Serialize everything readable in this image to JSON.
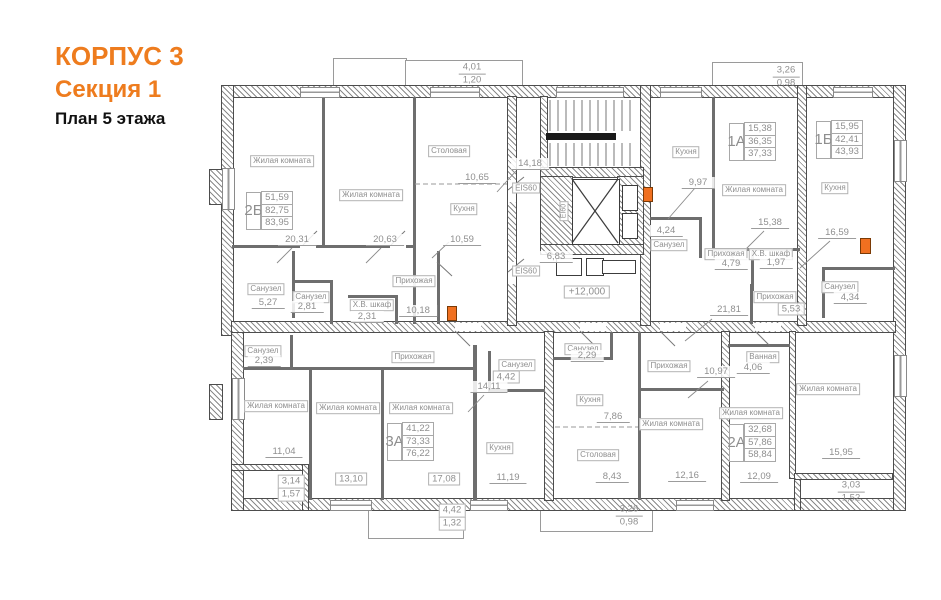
{
  "title": {
    "building": "КОРПУС 3",
    "section": "Секция 1",
    "plan": "План 5 этажа"
  },
  "colors": {
    "accent": "#ee7c1e",
    "wall": "#4d4d4d",
    "label_gray": "#8f8f8f",
    "fire_marker": "#f07020"
  },
  "core": {
    "fire_rating_top": "EIS60",
    "fire_rating_bottom": "EIS60",
    "elevator_rating": "EI60",
    "elevation": "+12,000"
  },
  "rooms": [
    {
      "label": "Жилая комната",
      "area": "20,31"
    },
    {
      "label": "Жилая комната",
      "area": "20,63"
    },
    {
      "label": "Столовая",
      "area": "10,65"
    },
    {
      "label": "Кухня",
      "area": "10,59"
    },
    {
      "label": "Санузел",
      "area": "5,27"
    },
    {
      "label": "Санузел",
      "area": "2,81"
    },
    {
      "label": "Х.В. шкаф",
      "area": "2,31"
    },
    {
      "label": "Прихожая",
      "area": "10,18"
    },
    {
      "label": "Кухня",
      "area": "9,97"
    },
    {
      "label": "Санузел",
      "area": "4,24"
    },
    {
      "label": "Жилая комната",
      "area": "15,38"
    },
    {
      "label": "Прихожая",
      "area": "4,79"
    },
    {
      "label": "Х.В. шкаф",
      "area": "1,97"
    },
    {
      "label": "Кухня",
      "area": "16,59"
    },
    {
      "label": "Санузел",
      "area": "4,34"
    },
    {
      "label": "Прихожая",
      "area": "5,53"
    },
    {
      "label": "Санузел",
      "area": "2,39"
    },
    {
      "label": "Прихожая",
      "area": ""
    },
    {
      "label": "Жилая комната",
      "area": "11,04"
    },
    {
      "label": "Жилая комната",
      "area": "13,10"
    },
    {
      "label": "Жилая комната",
      "area": "17,08"
    },
    {
      "label": "Санузел",
      "area": "4,42"
    },
    {
      "label": "Кухня",
      "area": "11,19"
    },
    {
      "label": "Санузел",
      "area": "2,29"
    },
    {
      "label": "Кухня",
      "area": "7,86"
    },
    {
      "label": "Столовая",
      "area": "8,43"
    },
    {
      "label": "Прихожая",
      "area": ""
    },
    {
      "label": "Ванная",
      "area": "4,06"
    },
    {
      "label": "Жилая комната",
      "area": "12,16"
    },
    {
      "label": "Жилая комната",
      "area": "12,09"
    },
    {
      "label": "Жилая комната",
      "area": "15,95"
    }
  ],
  "dims": [
    {
      "id": "stair-flight-area",
      "value": "14,18"
    },
    {
      "id": "lift-lobby-area",
      "value": "6,83"
    },
    {
      "id": "corridor-area",
      "value": "21,81"
    },
    {
      "id": "hall-area-3a",
      "value": "14,11"
    },
    {
      "id": "hall-area-2a",
      "value": "10,97"
    }
  ],
  "apartments": [
    {
      "unit": "2Б",
      "values": [
        "51,59",
        "82,75",
        "83,95"
      ]
    },
    {
      "unit": "1А",
      "values": [
        "15,38",
        "36,35",
        "37,33"
      ]
    },
    {
      "unit": "1Б",
      "values": [
        "15,95",
        "42,41",
        "43,93"
      ]
    },
    {
      "unit": "3А",
      "values": [
        "41,22",
        "73,33",
        "76,22"
      ]
    },
    {
      "unit": "2А",
      "values": [
        "32,68",
        "57,86",
        "58,84"
      ]
    }
  ],
  "balconies": [
    {
      "id": "top-center",
      "top": "4,01",
      "bottom": "1,20"
    },
    {
      "id": "top-right",
      "top": "3,26",
      "bottom": "0,98"
    },
    {
      "id": "bottom-center-left",
      "top": "4,42",
      "bottom": "1,32"
    },
    {
      "id": "bottom-center-right",
      "top": "3,26",
      "bottom": "0,98"
    },
    {
      "id": "loggia-bottom-left",
      "top": "3,14",
      "bottom": "1,57"
    },
    {
      "id": "loggia-bottom-right",
      "top": "3,03",
      "bottom": "1,52"
    }
  ]
}
